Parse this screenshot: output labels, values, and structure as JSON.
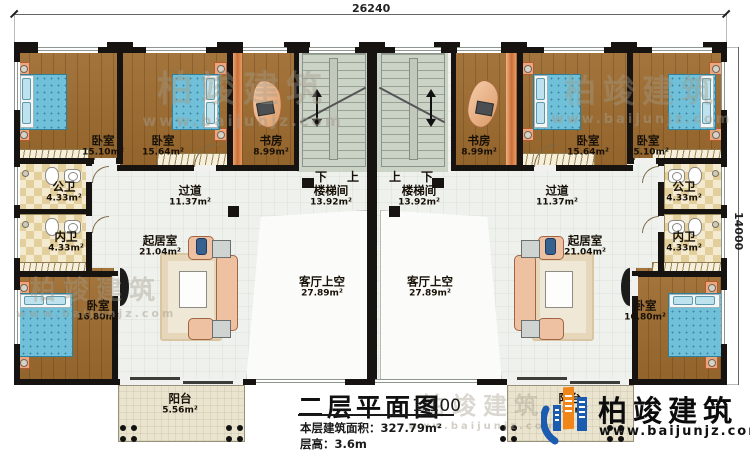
{
  "plan": {
    "dim_top": "26240",
    "dim_right": "14000",
    "stair_down": "下",
    "stair_up": "上"
  },
  "rooms": {
    "bedroom_a": {
      "name": "卧室",
      "area": "15.10m²"
    },
    "bedroom_b": {
      "name": "卧室",
      "area": "15.64m²"
    },
    "study": {
      "name": "书房",
      "area": "8.99m²"
    },
    "stairwell": {
      "name": "楼梯间",
      "area": "13.92m²"
    },
    "public_bath": {
      "name": "公卫",
      "area": "4.33m²"
    },
    "corridor": {
      "name": "过道",
      "area": "11.37m²"
    },
    "private_bath": {
      "name": "内卫",
      "area": "4.33m²"
    },
    "bedroom_c": {
      "name": "卧室",
      "area": "16.80m²"
    },
    "living": {
      "name": "起居室",
      "area": "21.04m²"
    },
    "void": {
      "name": "客厅上空",
      "area": "27.89m²"
    },
    "balcony": {
      "name": "阳台",
      "area": "5.56m²"
    }
  },
  "title_block": {
    "title": "二层平面图",
    "scale": "1:100",
    "area_line": "本层建筑面积：327.79m²",
    "height_line": "层高：3.6m"
  },
  "brand": {
    "name": "柏竣建筑",
    "website": "www.baijunjz.com"
  },
  "colors": {
    "wall": "#171310",
    "wood_floor": "#9d6b2e",
    "bed": "#6fc0d8",
    "logo_blue": "#1b5bb0",
    "logo_orange": "#f08519"
  }
}
